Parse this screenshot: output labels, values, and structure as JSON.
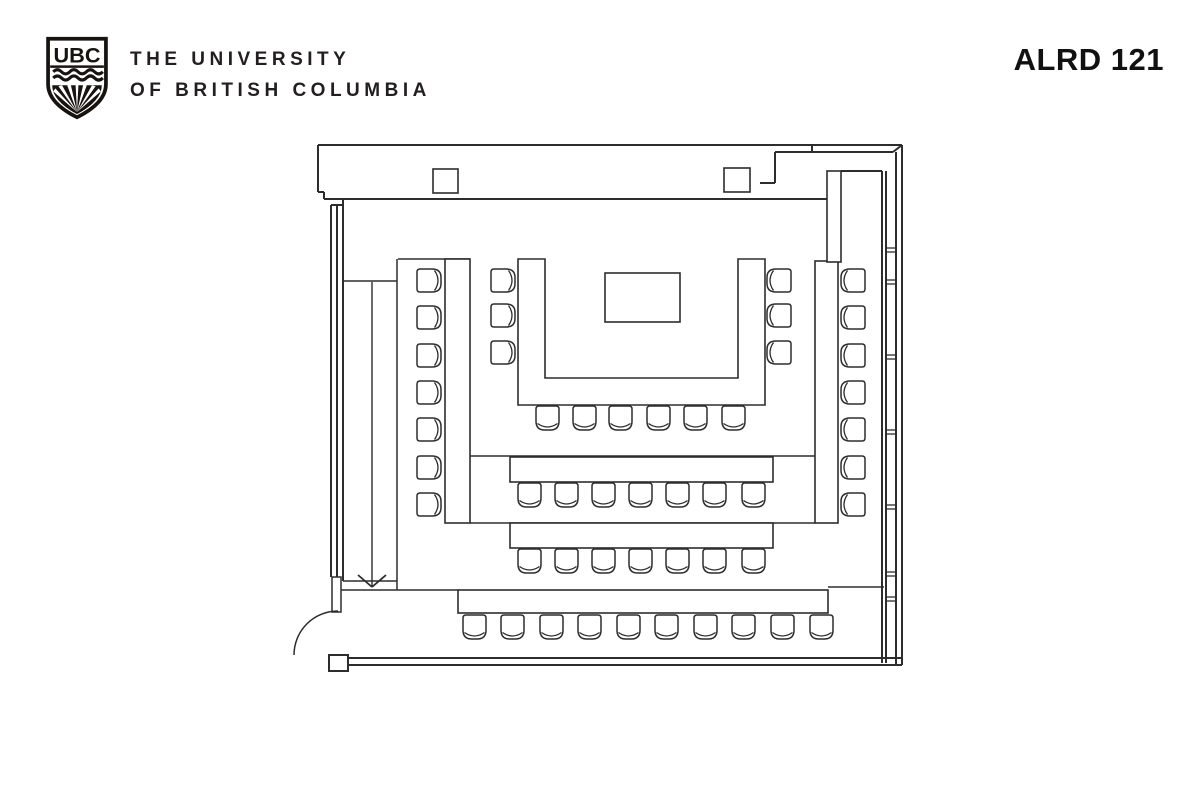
{
  "header": {
    "logo": {
      "acronym": "UBC"
    },
    "wordmark_line1": "THE UNIVERSITY",
    "wordmark_line2": "OF BRITISH COLUMBIA",
    "room_label": "ALRD 121"
  },
  "colors": {
    "line": "#2d2d2d",
    "text": "#231f20",
    "bg": "#ffffff"
  },
  "floorplan": {
    "seat_total": 50,
    "wall_lines": [
      [
        318,
        145,
        902,
        145
      ],
      [
        318,
        145,
        318,
        192
      ],
      [
        318,
        192,
        324,
        192
      ],
      [
        324,
        192,
        324,
        199
      ],
      [
        324,
        199,
        827,
        199
      ],
      [
        841,
        171,
        882,
        171
      ],
      [
        775,
        152,
        893,
        152
      ],
      [
        893,
        152,
        902,
        145
      ],
      [
        812,
        145,
        812,
        152
      ],
      [
        775,
        152,
        775,
        183
      ],
      [
        760,
        183,
        775,
        183
      ],
      [
        331,
        205,
        331,
        577
      ],
      [
        337,
        205,
        337,
        577
      ],
      [
        331,
        205,
        343,
        205
      ],
      [
        343,
        199,
        343,
        581
      ],
      [
        882,
        171,
        882,
        663
      ],
      [
        886,
        171,
        886,
        663
      ],
      [
        896,
        152,
        896,
        665
      ],
      [
        902,
        145,
        902,
        665
      ],
      [
        348,
        658,
        902,
        658
      ],
      [
        348,
        665,
        902,
        665
      ]
    ],
    "interior_lines": [
      [
        343,
        281,
        397,
        281
      ],
      [
        397,
        259,
        397,
        590
      ],
      [
        398,
        259,
        470,
        259
      ],
      [
        343,
        581,
        397,
        581
      ],
      [
        337,
        590,
        458,
        590
      ],
      [
        470,
        456,
        815,
        456
      ],
      [
        470,
        523,
        815,
        523
      ],
      [
        828,
        587,
        884,
        587
      ]
    ],
    "window_ticks": [
      248,
      280,
      355,
      430,
      505,
      572,
      597
    ],
    "door": {
      "leaf": {
        "x": 332,
        "y": 577,
        "w": 9,
        "h": 35
      },
      "arc_d": "M 294,655 A 44,44 0 0 1 338,611"
    },
    "bottom_cap": {
      "x": 329,
      "y": 655,
      "w": 19,
      "h": 16
    },
    "columns": [
      {
        "x": 433,
        "y": 169,
        "w": 25,
        "h": 24
      },
      {
        "x": 724,
        "y": 168,
        "w": 26,
        "h": 24
      }
    ],
    "u_table_d": "M 518,259 L 518,405 L 765,405 L 765,259 L 738,259 L 738,378 L 545,378 L 545,259 Z",
    "podium": {
      "x": 605,
      "y": 273,
      "w": 75,
      "h": 49
    },
    "tables": [
      {
        "name": "left-side-table",
        "x": 445,
        "y": 259,
        "w": 25,
        "h": 264
      },
      {
        "name": "right-side-table",
        "x": 815,
        "y": 261,
        "w": 23,
        "h": 262
      },
      {
        "name": "row-2-table",
        "x": 510,
        "y": 457,
        "w": 263,
        "h": 25
      },
      {
        "name": "row-3-table",
        "x": 510,
        "y": 523,
        "w": 263,
        "h": 25
      },
      {
        "name": "back-table",
        "x": 458,
        "y": 590,
        "w": 370,
        "h": 23
      },
      {
        "name": "wall-connector",
        "x": 827,
        "y": 171,
        "w": 14,
        "h": 91
      }
    ],
    "chair_size": 25,
    "chair_groups": [
      {
        "name": "left-side-chairs",
        "orientation": "left",
        "x": 417,
        "ys": [
          268,
          305,
          343,
          380,
          417,
          455,
          492
        ]
      },
      {
        "name": "right-side-chairs",
        "orientation": "right",
        "x": 840,
        "ys": [
          268,
          305,
          343,
          380,
          417,
          455,
          492
        ]
      },
      {
        "name": "u-left-chairs",
        "orientation": "left",
        "x": 491,
        "ys": [
          268,
          303,
          340
        ]
      },
      {
        "name": "u-right-chairs",
        "orientation": "right",
        "x": 766,
        "ys": [
          268,
          303,
          340
        ]
      },
      {
        "name": "u-bottom-chairs",
        "orientation": "down",
        "y": 406,
        "xs": [
          535,
          572,
          608,
          646,
          683,
          721
        ]
      },
      {
        "name": "row-2-chairs",
        "orientation": "down",
        "y": 483,
        "xs": [
          517,
          554,
          591,
          628,
          665,
          702,
          741
        ]
      },
      {
        "name": "row-3-chairs",
        "orientation": "down",
        "y": 549,
        "xs": [
          517,
          554,
          591,
          628,
          665,
          702,
          741
        ]
      },
      {
        "name": "back-row-chairs",
        "orientation": "down",
        "y": 615,
        "xs": [
          462,
          500,
          539,
          577,
          616,
          654,
          693,
          731,
          770,
          809
        ]
      }
    ],
    "entry_arrow": {
      "x": 372,
      "y1": 282,
      "y2": 587,
      "head_w": 14,
      "head_h": 12
    }
  }
}
